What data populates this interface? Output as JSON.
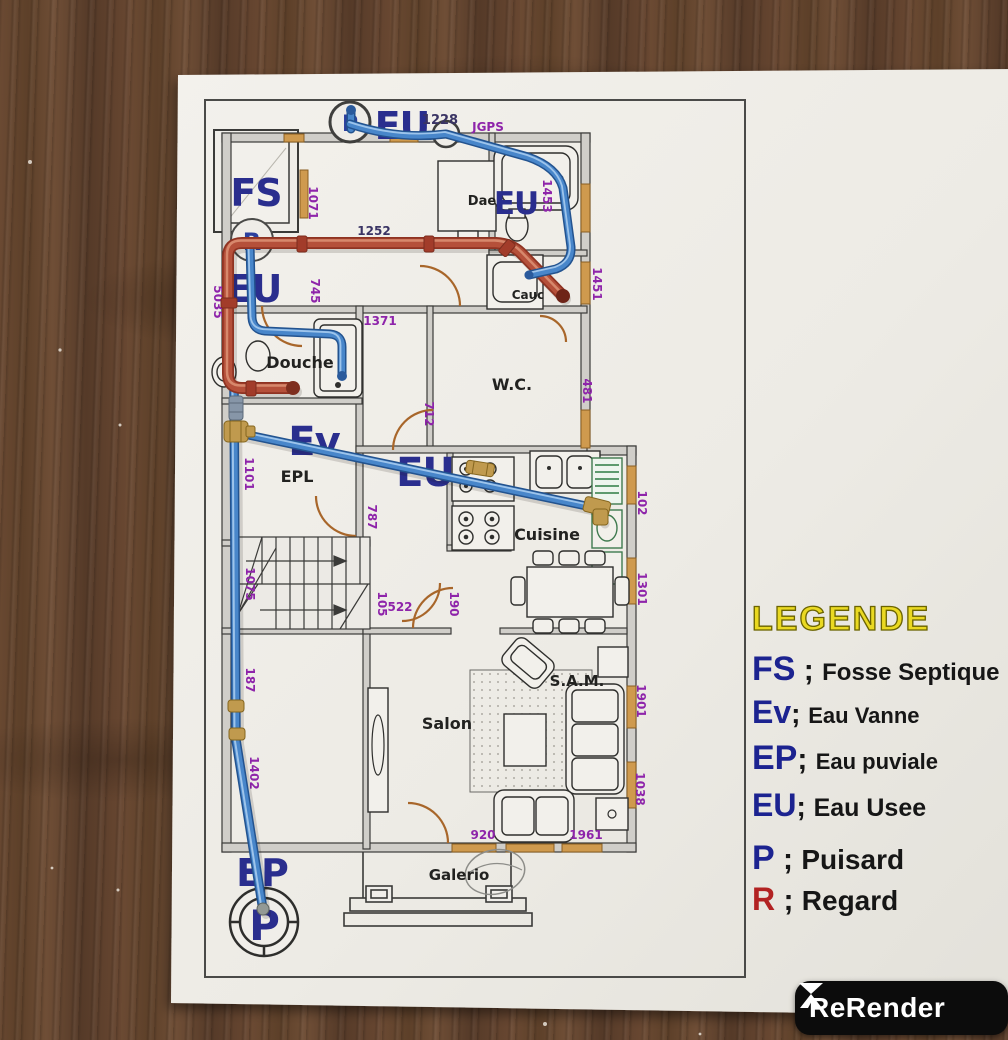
{
  "colors": {
    "pipe_blue": "#4886ca",
    "pipe_red": "#b5503a",
    "label_navy": "#2a2e8e",
    "dim_purple": "#8e24aa",
    "legend_yellow": "#ead922",
    "legend_red": "#b22222"
  },
  "legend": {
    "title": "LEGENDE",
    "entries": [
      {
        "abbr": "FS",
        "sep": " ; ",
        "label": "Fosse Septique"
      },
      {
        "abbr": "Ev",
        "sep": "; ",
        "label": "Eau Vanne"
      },
      {
        "abbr": "EP",
        "sep": "; ",
        "label": "Eau puviale"
      },
      {
        "abbr": "EU",
        "sep": "; ",
        "label": "Eau Usee"
      },
      {
        "abbr": "P",
        "sep": " ; ",
        "label": "Puisard"
      },
      {
        "abbr": "R",
        "sep": " ; ",
        "label": "Regard"
      }
    ]
  },
  "watermark": {
    "brand": "ReRender"
  },
  "plan": {
    "rooms": {
      "douche": "Douche",
      "wc": "W.C.",
      "epl": "EPL",
      "cuisine": "Cuisine",
      "salon": "Salon",
      "sam": "S.A.M.",
      "galerie": "Galerio",
      "dae": "Dae",
      "cauc": "Cauc"
    },
    "pipe_labels": {
      "fs": "FS",
      "eu_top": "EU",
      "eu_top_right": "EU",
      "eu_left": "EU",
      "ev": "Ev",
      "eu_center": "EU",
      "ep_bottom": "EP",
      "p_bottom": "P",
      "p_top": "P",
      "r_marker": "R"
    },
    "notes": {
      "n1228": "1228",
      "n1252": "1252"
    },
    "dims": [
      {
        "text": "JGPS"
      },
      {
        "text": "1071"
      },
      {
        "text": "745"
      },
      {
        "text": "5035"
      },
      {
        "text": "1453"
      },
      {
        "text": "1451"
      },
      {
        "text": "1371"
      },
      {
        "text": "712"
      },
      {
        "text": "481"
      },
      {
        "text": "1101"
      },
      {
        "text": "787"
      },
      {
        "text": "1075"
      },
      {
        "text": "105"
      },
      {
        "text": "522"
      },
      {
        "text": "190"
      },
      {
        "text": "102"
      },
      {
        "text": "1301"
      },
      {
        "text": "187"
      },
      {
        "text": "1402"
      },
      {
        "text": "1901"
      },
      {
        "text": "1038"
      },
      {
        "text": "920"
      },
      {
        "text": "1961"
      }
    ]
  }
}
